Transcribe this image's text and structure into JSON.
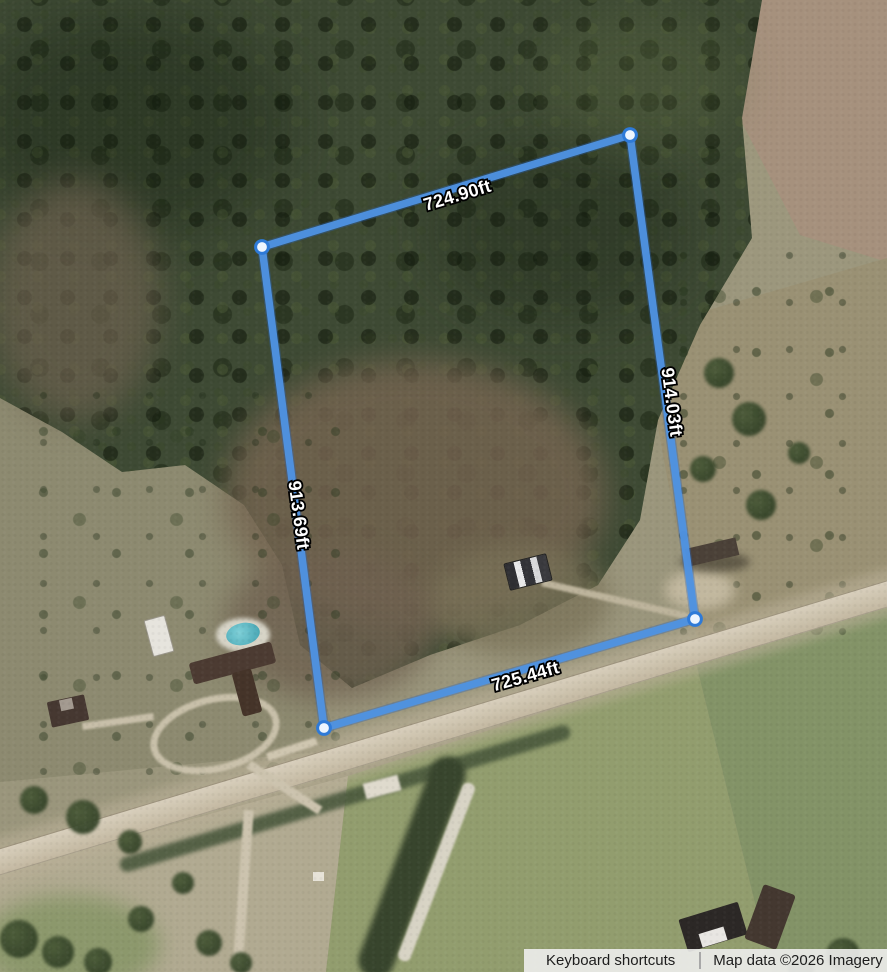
{
  "measure_tool": {
    "unit": "ft",
    "edges": [
      {
        "side": "top",
        "label": "724.90ft"
      },
      {
        "side": "right",
        "label": "914.03ft"
      },
      {
        "side": "left",
        "label": "913.69ft"
      },
      {
        "side": "bottom",
        "label": "725.44ft"
      }
    ]
  },
  "attribution": {
    "keyboard_shortcuts_label": "Keyboard shortcuts",
    "map_data_label": "Map data ©2026 Imagery ©20"
  },
  "colors": {
    "measure_line": "#4f93e3",
    "vertex_fill": "#edf5ff",
    "vertex_ring": "#2e7ad8",
    "label_text": "#ffffff",
    "label_outline": "#000000",
    "attribution_bg": "#eeeeed",
    "attribution_text": "#1d1d1d"
  }
}
